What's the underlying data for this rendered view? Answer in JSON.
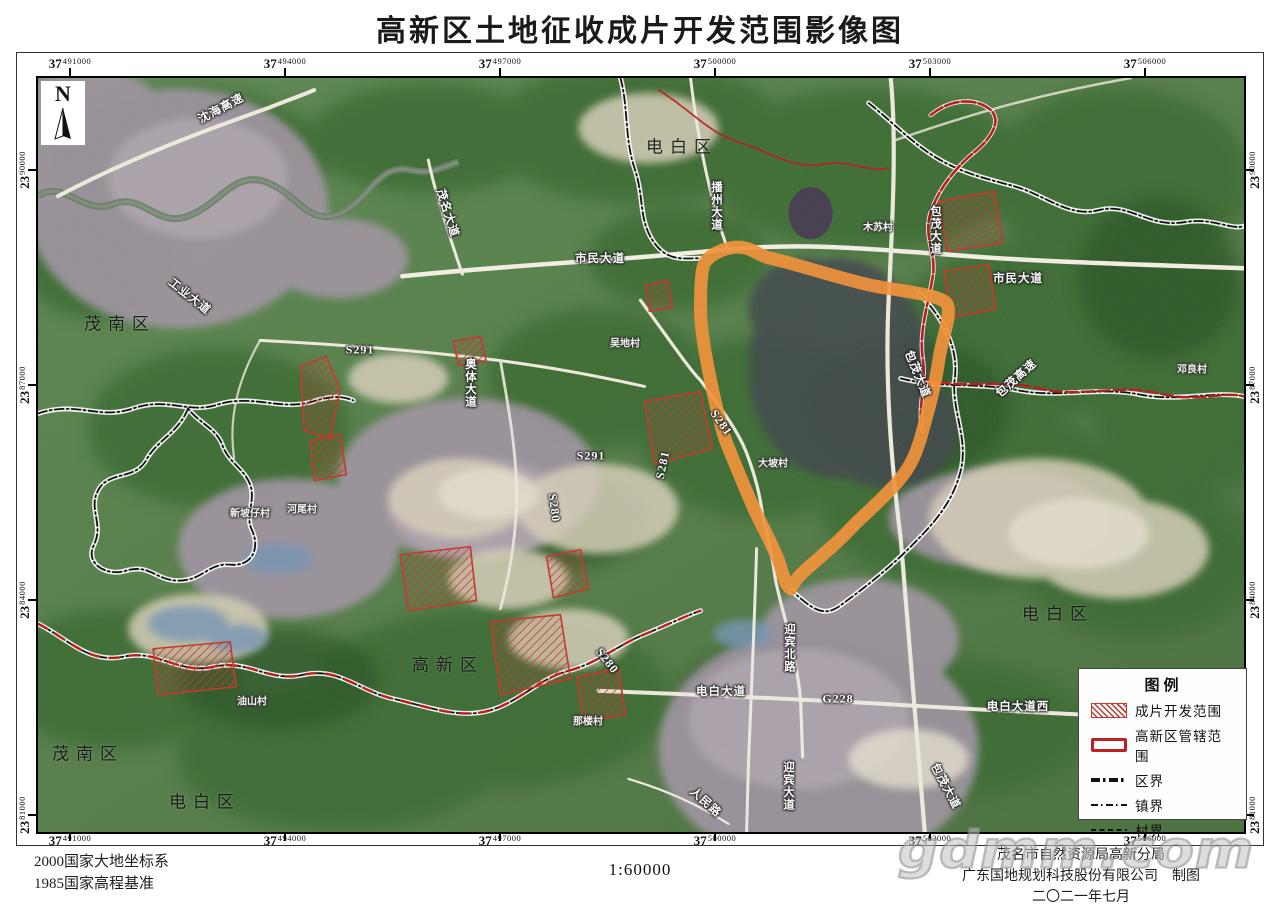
{
  "title": "高新区土地征收成片开发范围影像图",
  "north": {
    "label": "N"
  },
  "axes": {
    "zone_x": "37",
    "zone_y": "23",
    "x": [
      {
        "v": "491000",
        "x": 70
      },
      {
        "v": "494000",
        "x": 285
      },
      {
        "v": "497000",
        "x": 500
      },
      {
        "v": "500000",
        "x": 715
      },
      {
        "v": "503000",
        "x": 930
      },
      {
        "v": "506000",
        "x": 1145
      }
    ],
    "y": [
      {
        "v": "90000",
        "y": 170
      },
      {
        "v": "87000",
        "y": 385
      },
      {
        "v": "84000",
        "y": 600
      },
      {
        "v": "81000",
        "y": 815
      }
    ]
  },
  "legend": {
    "title": "图例",
    "items": [
      {
        "type": "hatch",
        "label": "成片开发范围"
      },
      {
        "type": "redbox",
        "label": "高新区管辖范围"
      },
      {
        "type": "dash-bold",
        "label": "区界"
      },
      {
        "type": "dash-mid",
        "label": "镇界"
      },
      {
        "type": "dash-fine",
        "label": "村界"
      }
    ]
  },
  "map": {
    "district_labels": [
      {
        "t": "电白区",
        "x": 644,
        "y": 67
      },
      {
        "t": "茂南区",
        "x": 82,
        "y": 244
      },
      {
        "t": "茂南区",
        "x": 50,
        "y": 674
      },
      {
        "t": "电白区",
        "x": 167,
        "y": 722
      },
      {
        "t": "高新区",
        "x": 410,
        "y": 585
      },
      {
        "t": "电白区",
        "x": 1020,
        "y": 534
      }
    ],
    "road_labels": [
      {
        "t": "沈海高速",
        "x": 183,
        "y": 30,
        "rot": -28
      },
      {
        "t": "工业大道",
        "x": 152,
        "y": 218,
        "rot": 38
      },
      {
        "t": "茂名大道",
        "x": 410,
        "y": 135,
        "rot": 72
      },
      {
        "t": "市民大道",
        "x": 562,
        "y": 180,
        "rot": 0
      },
      {
        "t": "市民大道",
        "x": 980,
        "y": 200,
        "rot": 0
      },
      {
        "t": "播州大道",
        "x": 678,
        "y": 128,
        "vert": true
      },
      {
        "t": "奥体大道",
        "x": 432,
        "y": 305,
        "vert": true
      },
      {
        "t": "包茂大道",
        "x": 897,
        "y": 152,
        "vert": true
      },
      {
        "t": "包茂大道",
        "x": 880,
        "y": 296,
        "rot": 68
      },
      {
        "t": "包茂高速",
        "x": 978,
        "y": 300,
        "rot": -42
      },
      {
        "t": "S291",
        "x": 322,
        "y": 272,
        "rot": 0
      },
      {
        "t": "S291",
        "x": 553,
        "y": 378,
        "rot": 0
      },
      {
        "t": "S281",
        "x": 683,
        "y": 345,
        "rot": 55
      },
      {
        "t": "S281",
        "x": 625,
        "y": 387,
        "rot": -78
      },
      {
        "t": "S280",
        "x": 516,
        "y": 430,
        "rot": 82
      },
      {
        "t": "S280",
        "x": 569,
        "y": 583,
        "rot": 52
      },
      {
        "t": "G228",
        "x": 800,
        "y": 621,
        "rot": 0
      },
      {
        "t": "电白大道",
        "x": 683,
        "y": 613,
        "rot": 0
      },
      {
        "t": "电白大道西",
        "x": 980,
        "y": 628,
        "rot": 0
      },
      {
        "t": "迎宾北路",
        "x": 751,
        "y": 570,
        "vert": true
      },
      {
        "t": "迎宾大道",
        "x": 750,
        "y": 708,
        "vert": true
      },
      {
        "t": "人民路",
        "x": 668,
        "y": 724,
        "rot": 42
      },
      {
        "t": "包茂大道",
        "x": 908,
        "y": 708,
        "rot": 62
      }
    ],
    "village_labels": [
      {
        "t": "木苏村",
        "x": 840,
        "y": 148
      },
      {
        "t": "吴地村",
        "x": 587,
        "y": 264
      },
      {
        "t": "大坡村",
        "x": 735,
        "y": 384
      },
      {
        "t": "邓良村",
        "x": 1154,
        "y": 290
      },
      {
        "t": "那楼村",
        "x": 550,
        "y": 642
      },
      {
        "t": "油山村",
        "x": 214,
        "y": 622
      },
      {
        "t": "新坡仔村",
        "x": 212,
        "y": 434
      },
      {
        "t": "河尾村",
        "x": 264,
        "y": 430
      }
    ]
  },
  "footer": {
    "datum1": "2000国家大地坐标系",
    "datum2": "1985国家高程基准",
    "scale": "1:60000",
    "credit1": "茂名市自然资源局高新分局",
    "credit2": "广东国地规划科技股份有限公司",
    "credit2_suffix": "制图",
    "credit3": "二〇二一年七月"
  },
  "watermark": "gdmm.com",
  "colors": {
    "highlight_orange": "#f0923c",
    "jurisdiction_red": "#b81f1f",
    "hatch_red": "#c43a2c",
    "boundary_black": "#111111"
  }
}
